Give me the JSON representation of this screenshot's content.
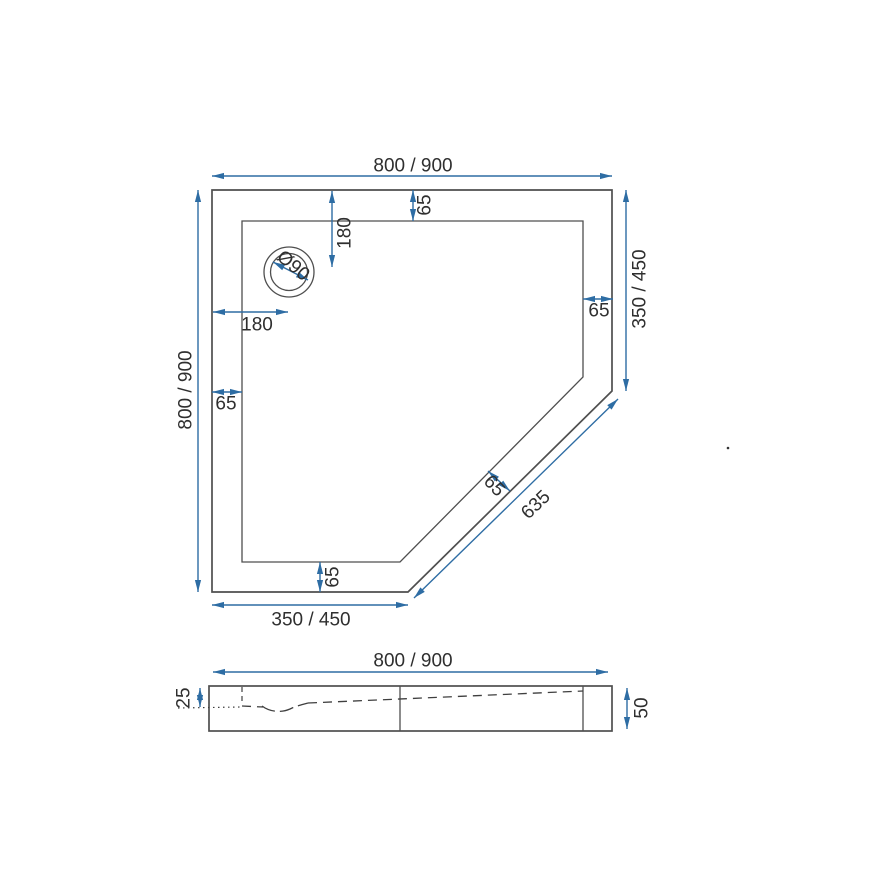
{
  "colors": {
    "background": "#ffffff",
    "outline": "#4f4f4f",
    "dimension_blue": "#2e6da4",
    "label_text": "#2f2f2f"
  },
  "plan_view": {
    "top_width_label": "800 / 900",
    "left_height_label": "800 / 900",
    "right_height_label": "350 / 450",
    "bottom_width_label": "350 / 450",
    "diagonal_length_label": "635",
    "rim_top_label": "65",
    "rim_left_label": "65",
    "rim_right_label": "65",
    "rim_bottom_label": "65",
    "rim_diagonal_label": "65",
    "drain_diameter_label": "Ø90",
    "drain_offset_horizontal_label": "180",
    "drain_offset_vertical_label": "180"
  },
  "side_view": {
    "width_label": "800 / 900",
    "inner_depth_label": "25",
    "total_height_label": "50"
  }
}
